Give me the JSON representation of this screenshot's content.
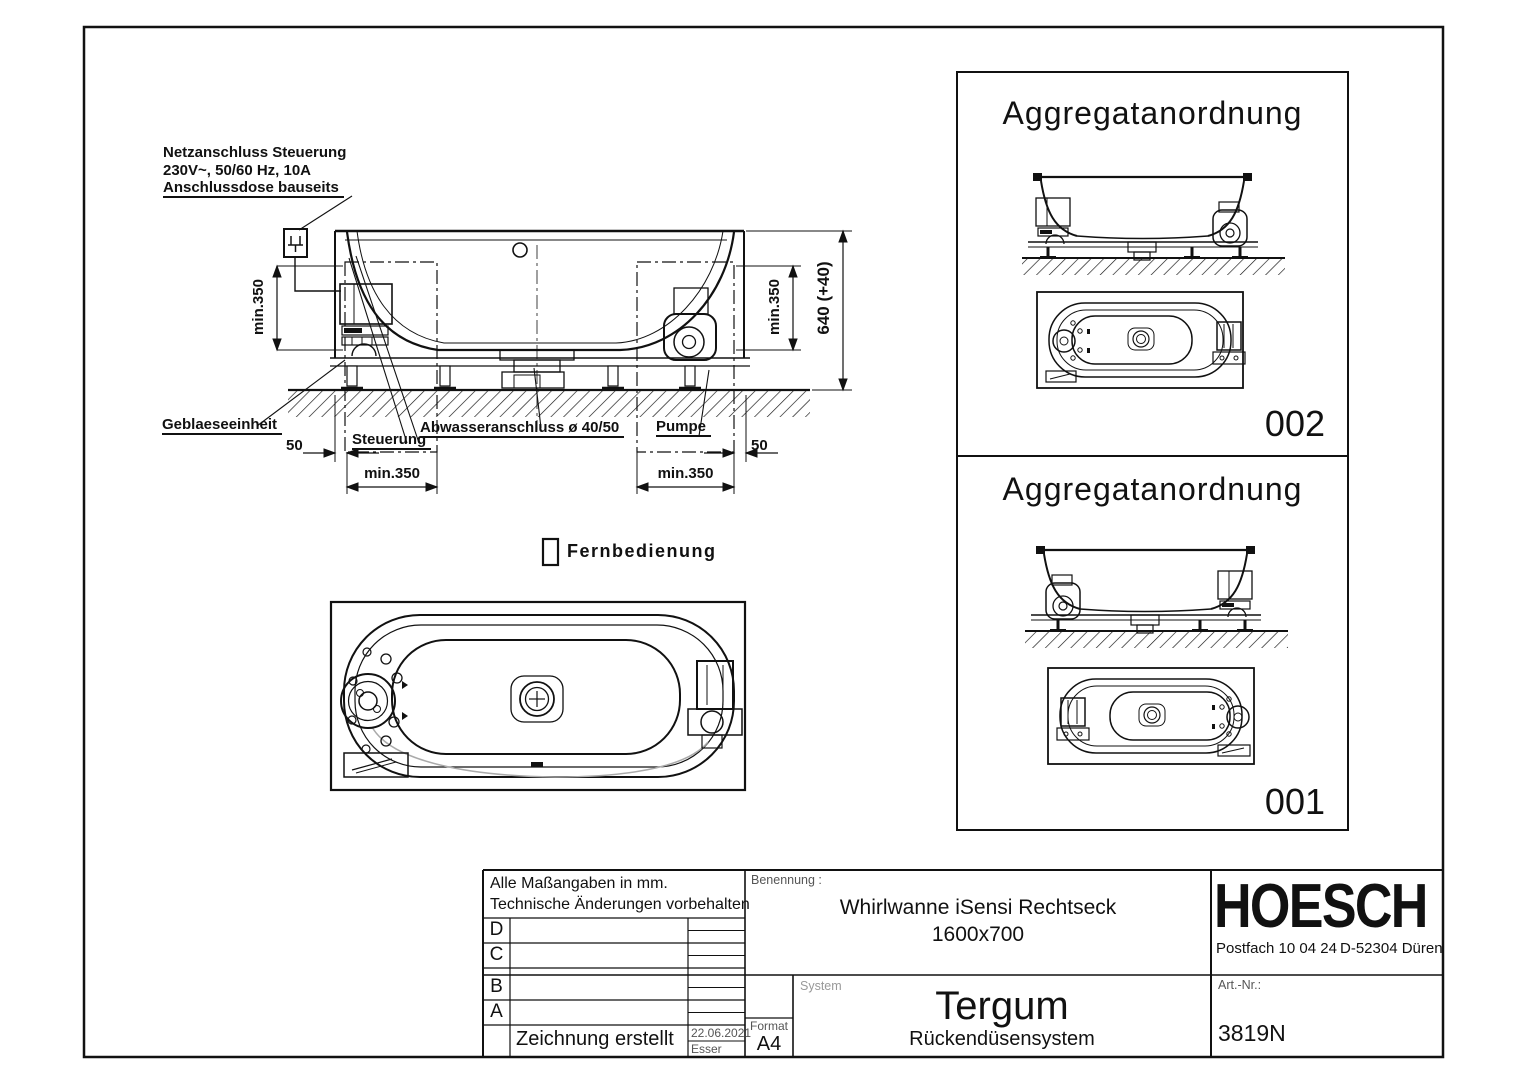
{
  "annotations": {
    "power_note_line1": "Netzanschluss Steuerung",
    "power_note_line2": "230V~, 50/60 Hz, 10A",
    "power_note_line3": "Anschlussdose bauseits",
    "blower_label": "Geblaeseeinheit",
    "control_label": "Steuerung",
    "drain_label": "Abwasseranschluss ø 40/50",
    "pump_label": "Pumpe",
    "remote_label": "Fernbedienung"
  },
  "dimensions": {
    "clearance_left_vertical": "min.350",
    "clearance_right_vertical": "min.350",
    "height_total": "640 (+40)",
    "gap_left": "50",
    "gap_right": "50",
    "clearance_left_bottom": "min.350",
    "clearance_right_bottom": "min.350"
  },
  "panels": [
    {
      "title": "Aggregatanordnung",
      "number": "002"
    },
    {
      "title": "Aggregatanordnung",
      "number": "001"
    }
  ],
  "icons": {
    "power_plug_icon": "mains-plug symbol",
    "remote_control_icon": "remote-control rectangle"
  },
  "title_block": {
    "note_line1": "Alle Maßangaben in mm.",
    "note_line2": "Technische Änderungen vorbehalten",
    "revision_rows": [
      "D",
      "C",
      "B",
      "A"
    ],
    "created_label": "Zeichnung erstellt",
    "created_date": "22.06.2021",
    "created_by": "Esser",
    "benennung_label": "Benennung :",
    "product_name": "Whirlwanne iSensi Rechtseck",
    "product_size": "1600x700",
    "system_label": "System",
    "system_name": "Tergum",
    "system_subtitle": "Rückendüsensystem",
    "format_label": "Format",
    "format_value": "A4",
    "brand": "HOESCH",
    "address_po_box": "Postfach 10 04 24",
    "address_city": "D-52304 Düren",
    "art_nr_label": "Art.-Nr.:",
    "art_nr_value": "3819N"
  }
}
